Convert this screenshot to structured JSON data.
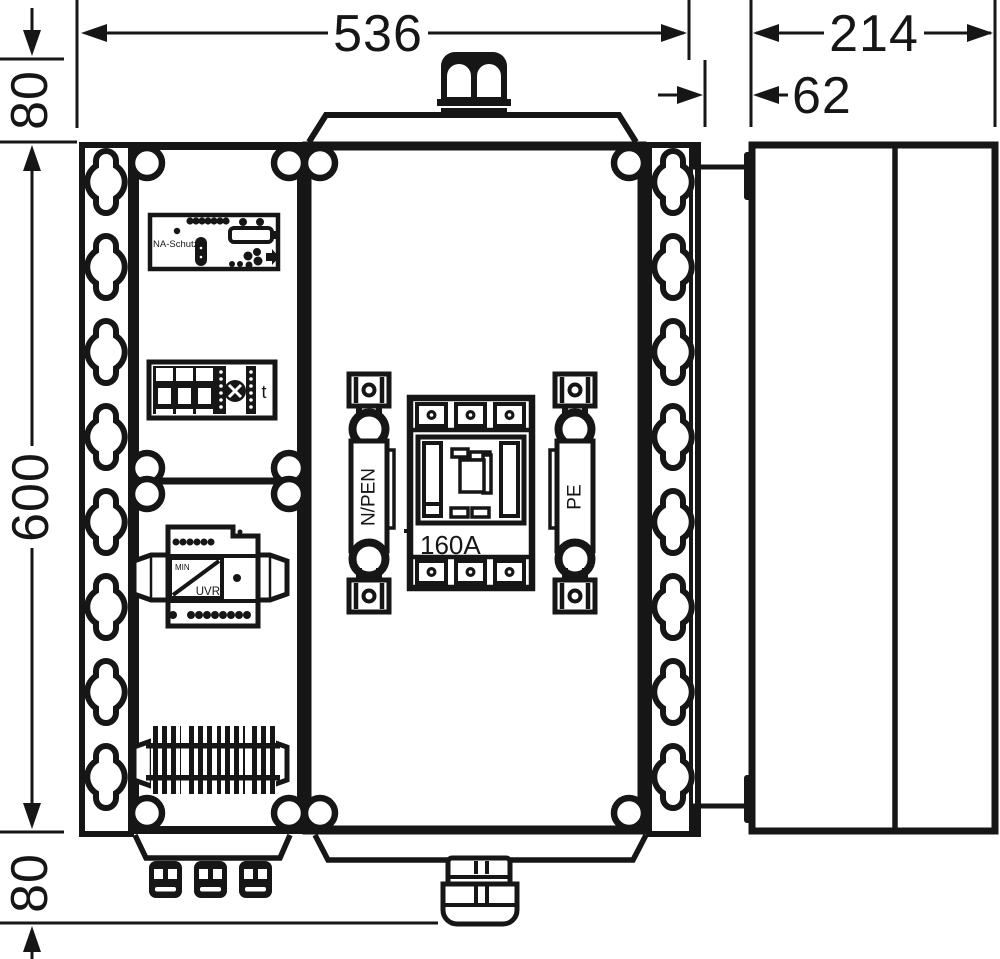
{
  "diagram": {
    "dims": {
      "width": "536",
      "depth": "214",
      "cover_depth": "62",
      "top_offset": "80",
      "height": "600",
      "bottom_offset": "80"
    },
    "labels": {
      "na_schutz": "NA-Schutz",
      "terminal_t": "t",
      "busbar_n_pen": "N/PEN",
      "breaker_rating": "160A",
      "busbar_pe": "PE",
      "uvr_top": "MIN",
      "uvr_bottom": "UVR"
    },
    "colors": {
      "ink": "#161616",
      "paper": "#ffffff"
    }
  }
}
